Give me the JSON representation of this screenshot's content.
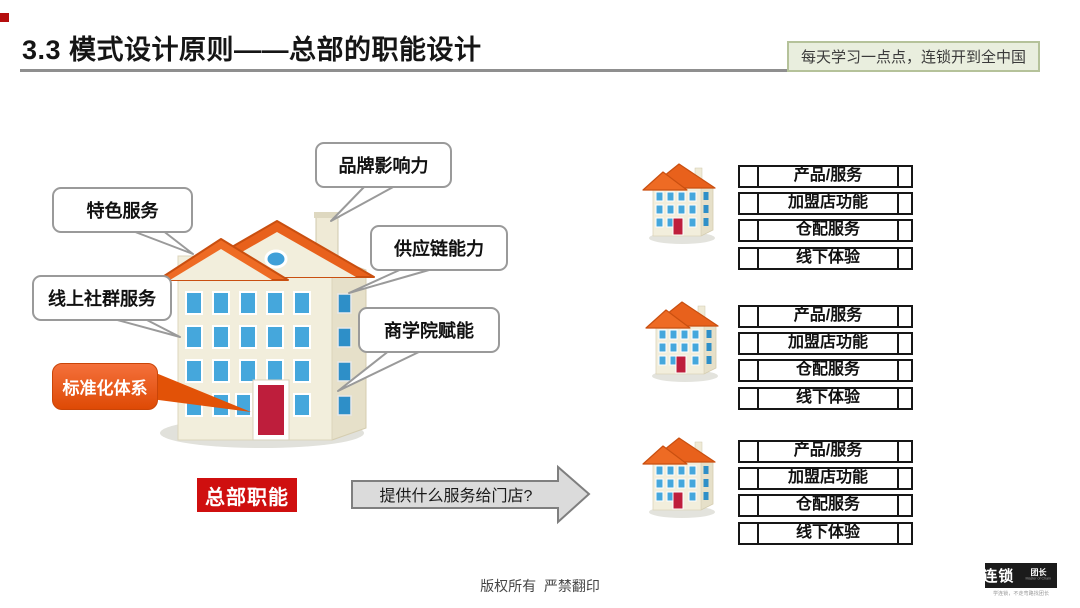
{
  "header": {
    "corner_marker_color": "#B50E0E",
    "title": "3.3 模式设计原则——总部的职能设计",
    "slogan": "每天学习一点点，连锁开到全中国"
  },
  "diagram": {
    "callouts": [
      {
        "label": "品牌影响力"
      },
      {
        "label": "特色服务"
      },
      {
        "label": "线上社群服务"
      },
      {
        "label": "供应链能力"
      },
      {
        "label": "商学院赋能"
      },
      {
        "label": "标准化体系"
      }
    ],
    "hq_label": "总部职能",
    "arrow_label": "提供什么服务给门店?",
    "store_groups": [
      {
        "items": [
          "产品/服务",
          "加盟店功能",
          "仓配服务",
          "线下体验"
        ]
      },
      {
        "items": [
          "产品/服务",
          "加盟店功能",
          "仓配服务",
          "线下体验"
        ]
      },
      {
        "items": [
          "产品/服务",
          "加盟店功能",
          "仓配服务",
          "线下体验"
        ]
      }
    ]
  },
  "footer": {
    "copyright": "版权所有  严禁翻印",
    "logo_primary": "连锁",
    "logo_secondary": "团长",
    "logo_sub": "Master of Chain",
    "logo_tagline": "学连锁，不走弯路找团长"
  },
  "colors": {
    "roof_orange": "#E8611C",
    "window_blue": "#45A7DC",
    "door_red": "#BE1E3C",
    "callout_orange": "#E8570F",
    "hq_red": "#CF0F0F",
    "slogan_bg": "#E9EEDE",
    "slogan_border": "#B5C29A",
    "underline_gray": "#8F8F8F"
  }
}
